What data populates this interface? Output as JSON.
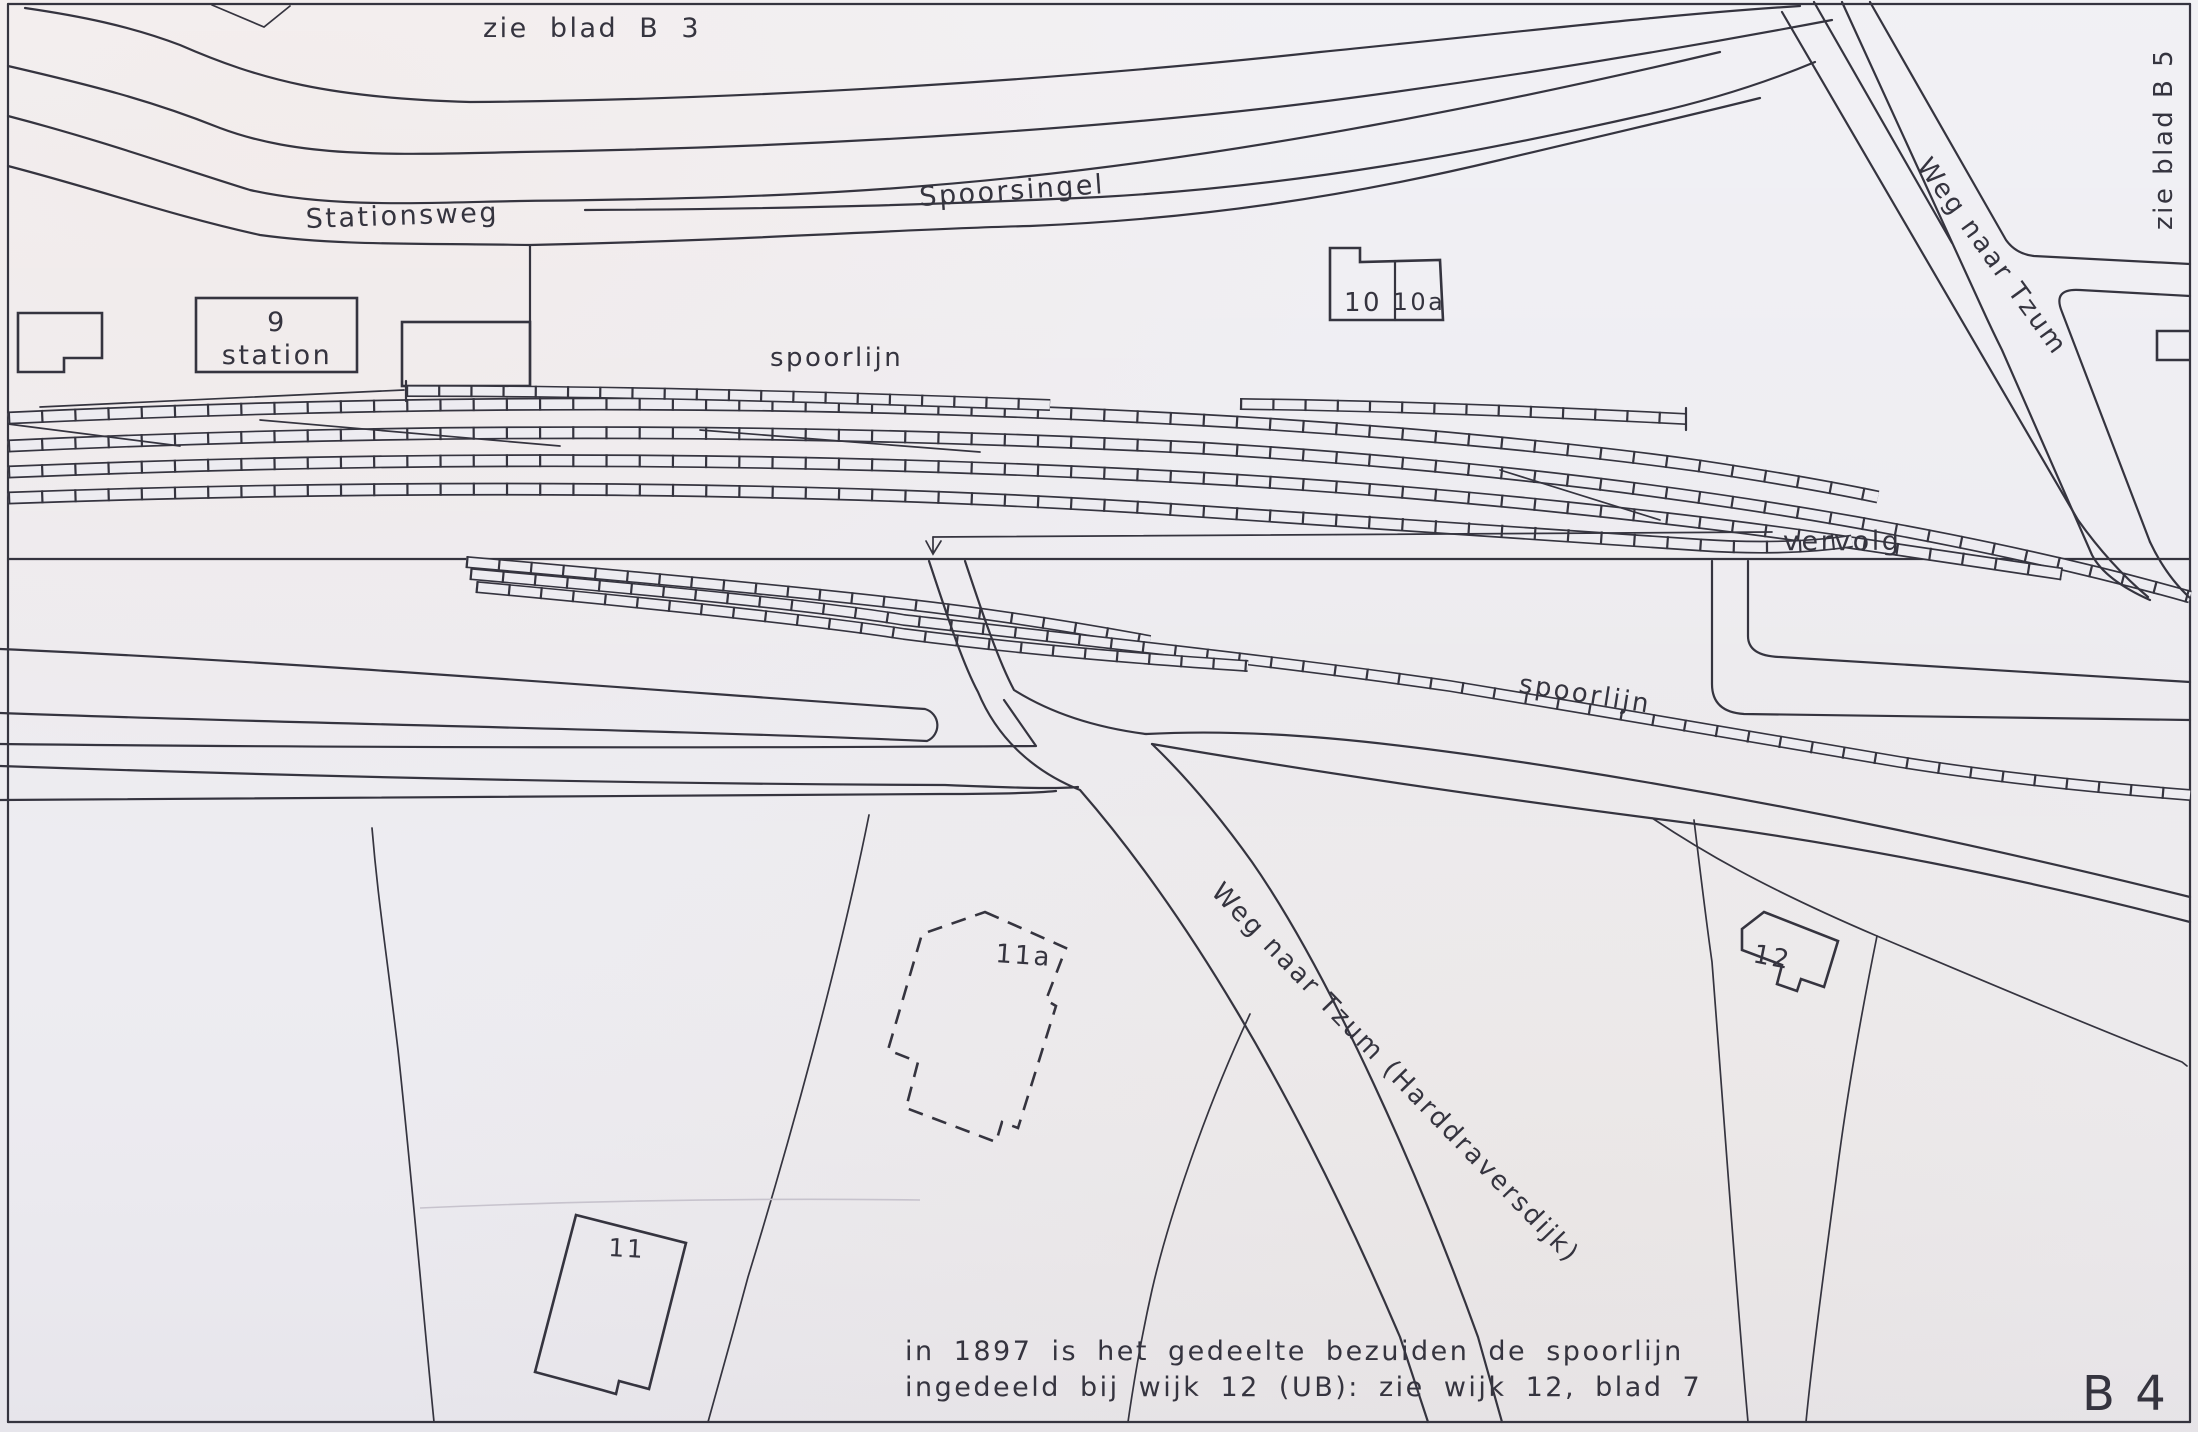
{
  "map": {
    "title": "kaartblad wijk B (station / spoorlijn)",
    "sheet_label": "B 4",
    "colors": {
      "ink": "#35343f",
      "paper": "#edecf1"
    },
    "references": {
      "top": "zie blad B 3",
      "right": "zie blad B 5",
      "continuation": "vervolg"
    },
    "streets": {
      "stationsweg": "Stationsweg",
      "spoorsingel": "Spoorsingel",
      "spoorlijn_top": "spoorlijn",
      "spoorlijn_bottom": "spoorlijn",
      "weg_naar_tzum_top": "Weg naar Tzum",
      "weg_naar_tzum_bottom": "Weg naar Tzum   (Harddraversdijk)"
    },
    "buildings": {
      "b9_number": "9",
      "b9_name": "station",
      "b10": "10",
      "b10a": "10a",
      "b11": "11",
      "b11a": "11a",
      "b12": "12"
    },
    "note": {
      "line1": "in 1897 is het gedeelte bezuiden de spoorlijn",
      "line2": "ingedeeld  bij  wijk 12 (UB):  zie wijk 12,  blad 7"
    }
  }
}
